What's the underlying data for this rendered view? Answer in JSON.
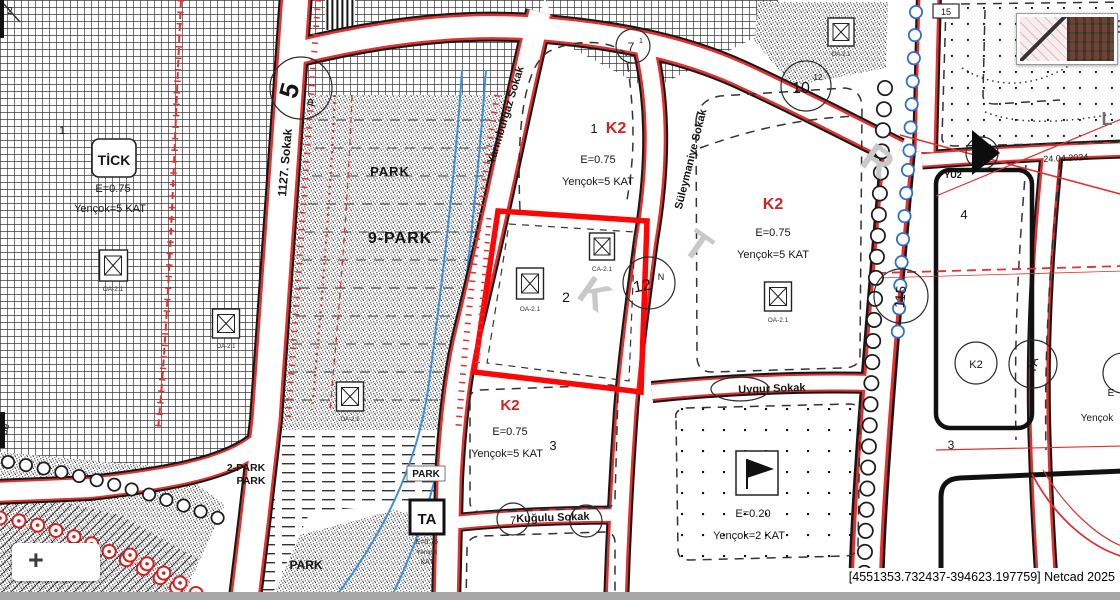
{
  "app": {
    "brand_status": "[4551353.732437-394623.197759] Netcad 2025",
    "zoom_in_label": "+",
    "survey_date": "24.04.2024"
  },
  "streets": {
    "s1127": "1127. Sokak",
    "yarimburgaz": "Yarımburgaz Sokak",
    "suleymaniye": "Süleymaniye Sokak",
    "uygur": "Uygur Sokak",
    "kugulu": "Kuğulu Sokak"
  },
  "parks": {
    "park_top": "PARK",
    "park9": "9-PARK",
    "park2": "2-PARK",
    "park2b": "PARK",
    "park_box": "PARK",
    "park_bottom": "PARK"
  },
  "parcels": {
    "p1": {
      "no": "1",
      "code": "TİCK",
      "e": "E=0.75",
      "h": "Yençok=5 KAT"
    },
    "p_upper": {
      "no": "1",
      "code": "K2",
      "e": "E=0.75",
      "h": "Yençok=5 KAT"
    },
    "p_sel": {
      "no": "2"
    },
    "p_big": {
      "code": "K2",
      "e": "E=0.75",
      "h": "Yençok=5 KAT"
    },
    "p3": {
      "no": "3",
      "code": "K2",
      "e": "E=0.75",
      "h": "Yençok=5 KAT"
    },
    "p_flag": {
      "e": "E=0.20",
      "h": "Yençok=2 KAT"
    },
    "p4": {
      "no": "4",
      "code": "YU2"
    },
    "p3r": {
      "no": "3"
    },
    "p_ta": {
      "code": "TA",
      "e": "E=0.75",
      "h": "Yençok",
      "k": "KAT"
    },
    "p_edge": {
      "e": "E",
      "h": "Yençok"
    }
  },
  "icons": {
    "trafo": "OA-2.1",
    "trafo_c": "CA-2.1"
  },
  "bubbles": {
    "b5": "5",
    "b5p": "P",
    "b7": "7",
    "b7s": "1",
    "b10": "10",
    "b10s": "12",
    "b12": "12",
    "b12s": "N",
    "b115": "115",
    "bk2": "K2",
    "b7a": "7A",
    "bkug": "7",
    "b15": "15"
  },
  "watermark": {
    "k": "K",
    "t": "T",
    "r": "R",
    "te": "TE",
    "l": "L"
  },
  "corner": {
    "two": "2",
    "de": "de"
  },
  "colors": {
    "selected_parcel": "#ff0505",
    "zone_code_red": "#d32222",
    "stream_blue": "#3f8fe0",
    "road_casing_red": "#e03030"
  }
}
